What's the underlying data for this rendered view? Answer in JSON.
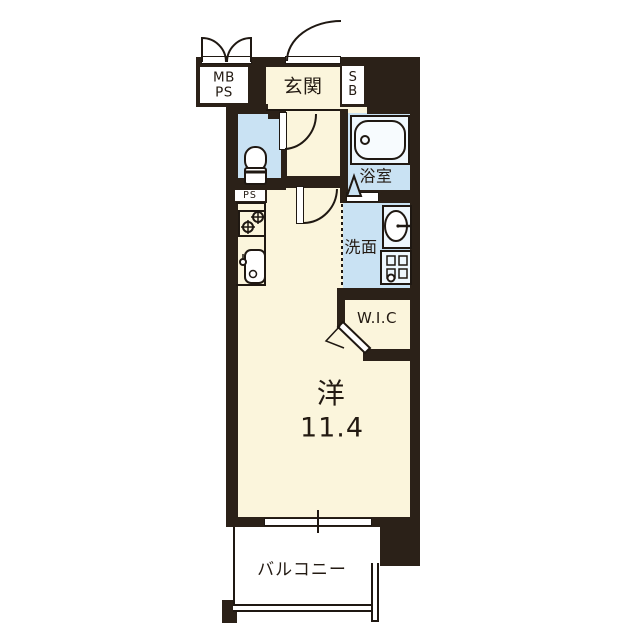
{
  "plan": {
    "title": "apartment-floor-plan",
    "rooms": {
      "mbps": {
        "line1": "MB",
        "line2": "PS"
      },
      "genkan": {
        "label": "玄関"
      },
      "sb": {
        "line1": "S",
        "line2": "B"
      },
      "bathroom": {
        "label": "浴室"
      },
      "washroom": {
        "label": "洗面"
      },
      "wic": {
        "label": "W.I.C"
      },
      "ps": {
        "label": "PS"
      },
      "main": {
        "label": "洋",
        "size": "11.4"
      },
      "balcony": {
        "label": "バルコニー"
      }
    },
    "colors": {
      "wall": "#2b2118",
      "room_cream": "#fbf5dc",
      "room_blue": "#c9e2f3",
      "white": "#ffffff",
      "line": "#1f1812"
    }
  }
}
